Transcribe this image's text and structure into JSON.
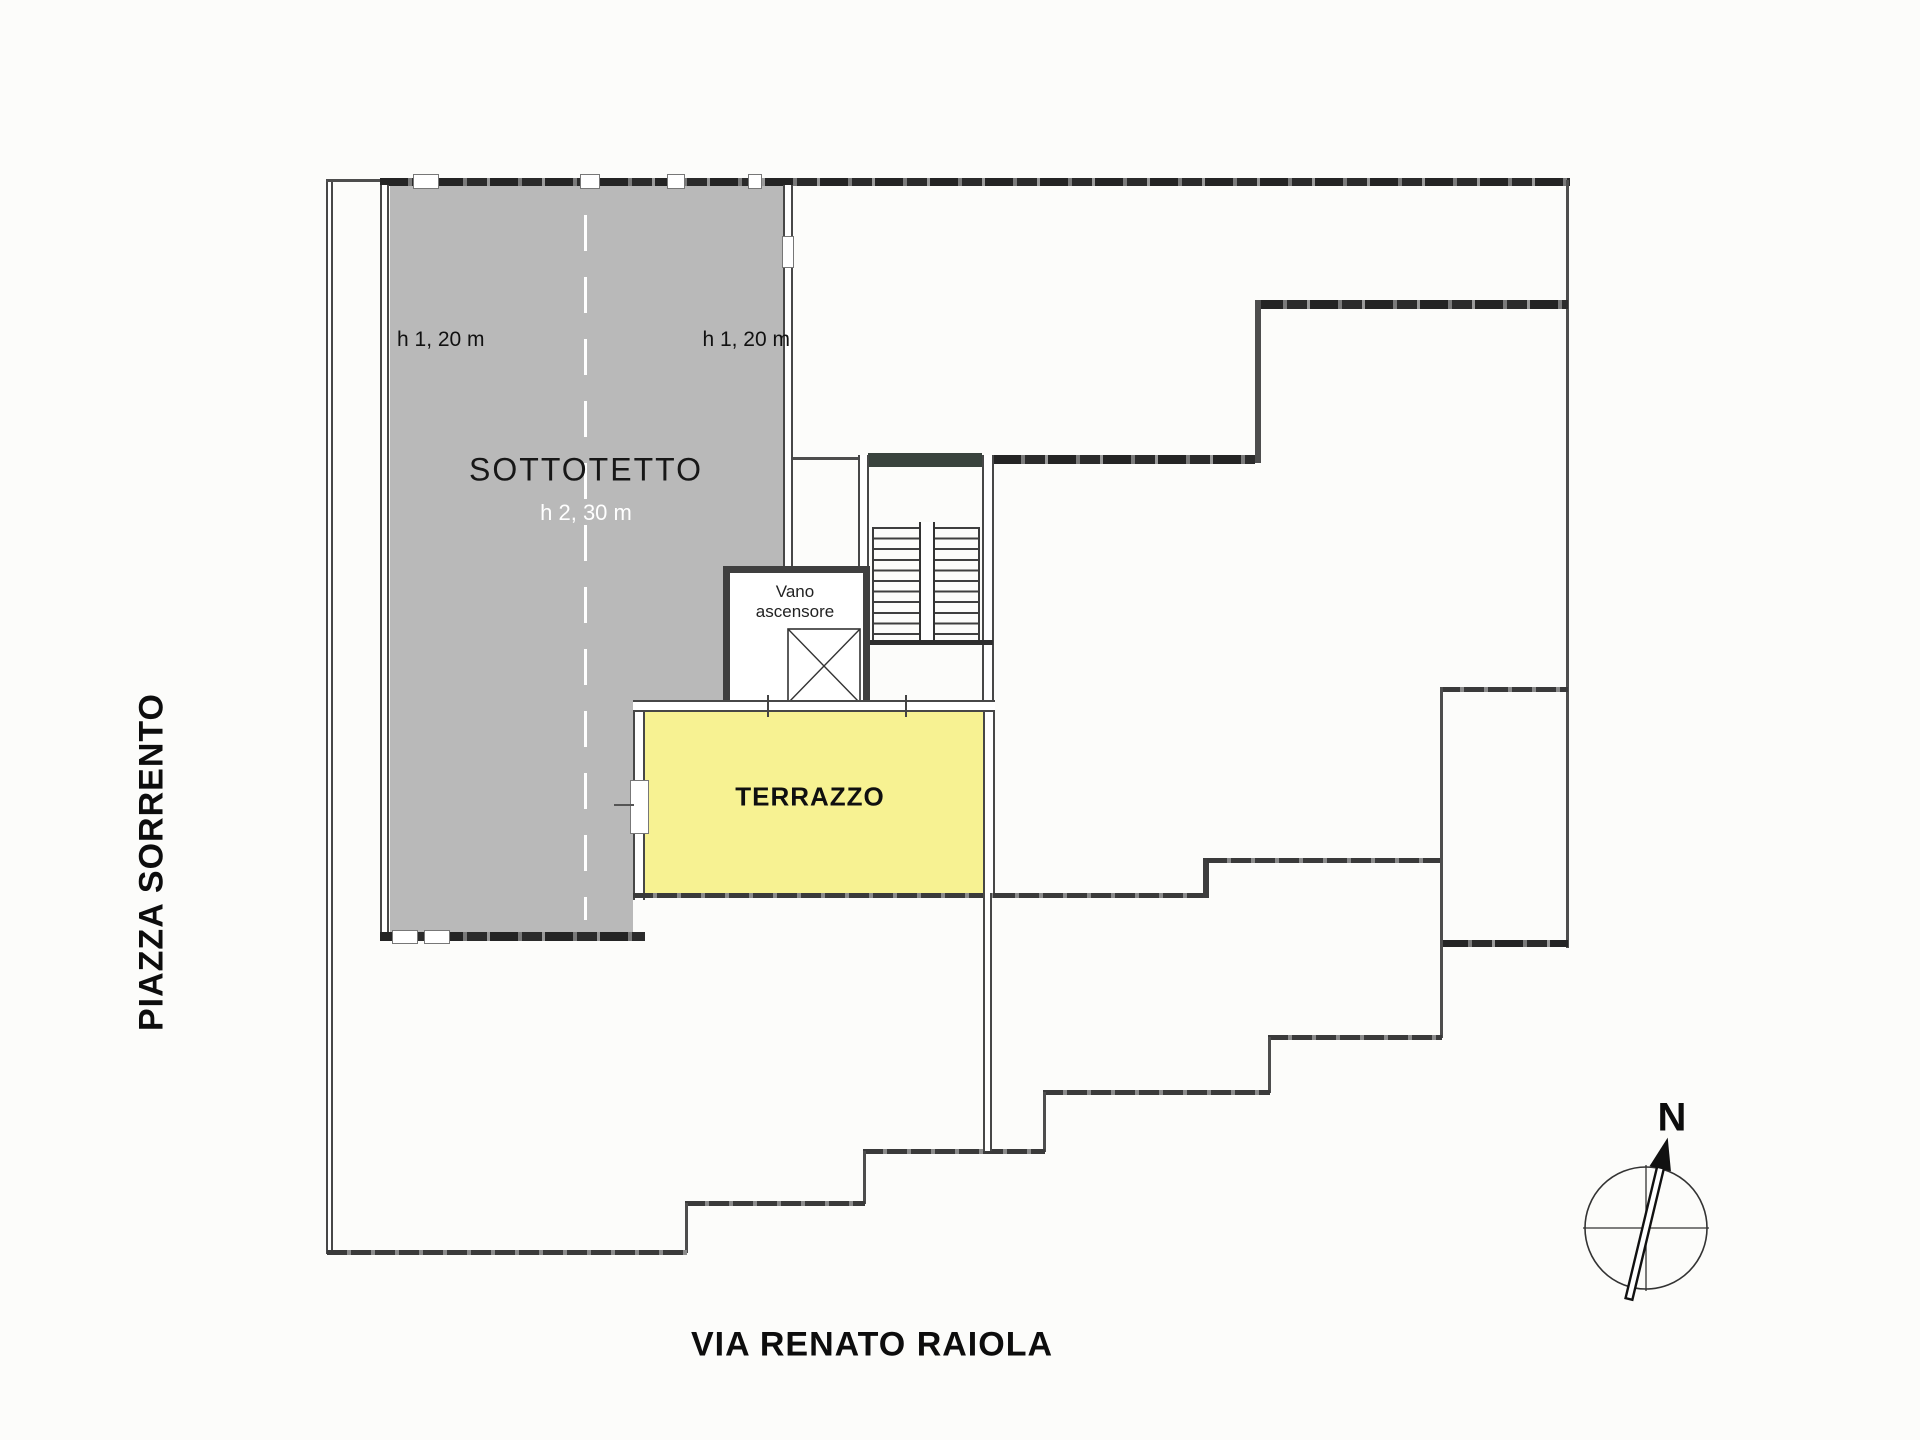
{
  "plan_title": "floor-plan",
  "streets": {
    "left": "PIAZZA SORRENTO",
    "bottom": "VIA RENATO RAIOLA"
  },
  "rooms": {
    "sottotetto": {
      "label": "SOTTOTETTO",
      "center_height": "h 2, 30 m",
      "left_height": "h 1, 20 m",
      "right_height": "h 1, 20 m",
      "fill": "#b9b9b9"
    },
    "terrazzo": {
      "label": "TERRAZZO",
      "fill": "#f7f292"
    },
    "elevator": {
      "line1": "Vano",
      "line2": "ascensore"
    }
  },
  "compass": {
    "north_label": "N"
  },
  "colors": {
    "wall_dark": "#2e2e2e",
    "boundary_line": "#4d4d4d",
    "stair_header": "#39433d",
    "paper": "#fcfcfa"
  }
}
